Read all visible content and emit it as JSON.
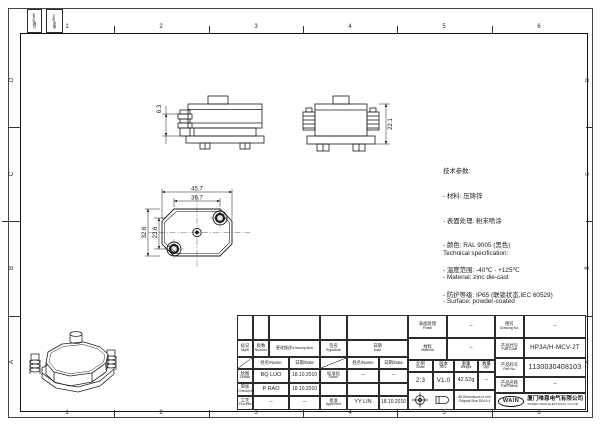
{
  "sheet": {
    "zones_cols": [
      "1",
      "2",
      "3",
      "4",
      "5",
      "6"
    ],
    "zones_rows": [
      "D",
      "C",
      "B",
      "A"
    ]
  },
  "rev_strip": {
    "date_label": "日期/Date",
    "rev_label": "更改/Rev"
  },
  "dims": {
    "side": "6.3",
    "front": "22.1",
    "top_outer_w": "45.7",
    "top_inner_w": "36.7",
    "top_outer_h": "32.6",
    "top_inner_h": "23.6"
  },
  "specs_cn": {
    "title": "技术参数:",
    "items": [
      "- 材料: 压铸锌",
      "- 表面处理: 粉末喷涂",
      "- 颜色: RAL 9005 (黑色)",
      "- 温度范围: -40℃ - +125℃",
      "- 防护等级: IP65 (联锁状态,IEC 60529)"
    ]
  },
  "specs_en": {
    "title": "Technical specification:",
    "items": [
      "- Material: zinc die-cast",
      "- Surface: powder-coated",
      "- Colour: RAL 9005(black)",
      "- Temperature range: -40℃ - +125℃",
      "- Degree of protection: IP65",
      "  (acc.to IEC 60529 for coupled connector)"
    ]
  },
  "title_block": {
    "rev_header": {
      "mark_cn": "标记",
      "mark_en": "Mark",
      "number_cn": "处数",
      "number_en": "Number",
      "description": "更改描述/Description",
      "signature_cn": "签名",
      "signature_en": "Signature",
      "date_cn": "日期",
      "date_en": "Date"
    },
    "sig_header": {
      "name": "姓名/Name",
      "date": "日期/Date"
    },
    "rows_left": [
      {
        "cn": "绘图",
        "en": "Drawn",
        "name": "BQ LUO",
        "date": "18.10.2010"
      },
      {
        "cn": "审核",
        "en": "Checked",
        "name": "P RAO",
        "date": "18.10.2010"
      },
      {
        "cn": "工艺",
        "en": "Process",
        "name": "–",
        "date": "–"
      }
    ],
    "rows_right": [
      {
        "cn": "标准化",
        "en": "Stand.",
        "name": "–",
        "date": "–"
      },
      {
        "cn": "",
        "en": "",
        "name": "",
        "date": ""
      },
      {
        "cn": "批准",
        "en": "Approved",
        "name": "YY LIN",
        "date": "18.10.2010"
      }
    ],
    "info": {
      "finish_cn": "表面处理",
      "finish_en": "Finish",
      "finish_val": "–",
      "material_cn": "材料",
      "material_en": "Material",
      "material_val": "–",
      "scale_cn": "比例",
      "scale_en": "Scale",
      "scale_val": "2:3",
      "rev_cn": "版本",
      "rev_en": "REV.",
      "rev_val": "V1.0",
      "weight_cn": "重量",
      "weight_en": "Weight",
      "weight_val": "42.52g",
      "qty_cn": "数量",
      "qty_en": "Qty.",
      "qty_val": "–",
      "drawing_no_cn": "图号",
      "drawing_no_en": "Drawing No.",
      "drawing_no_val": "–",
      "part_code_cn": "产品代号",
      "part_code_en": "Part Code",
      "part_code_val": "HP3A/H-MCV-2T",
      "part_no_cn": "产品料号",
      "part_no_en": "Part No.",
      "part_no_val": "1130030408103",
      "part_name_cn": "产品名称",
      "part_name_en": "Part Name",
      "part_name_val": "–",
      "note_line1": "All Dimensions in mm",
      "note_line2": "Original Size DIN A 4"
    },
    "company": {
      "logo": "WAIN",
      "cn": "厦门唯恩电气有限公司",
      "en": "XIAMEN WAIN ELECTRICAL CO.LTD"
    }
  }
}
